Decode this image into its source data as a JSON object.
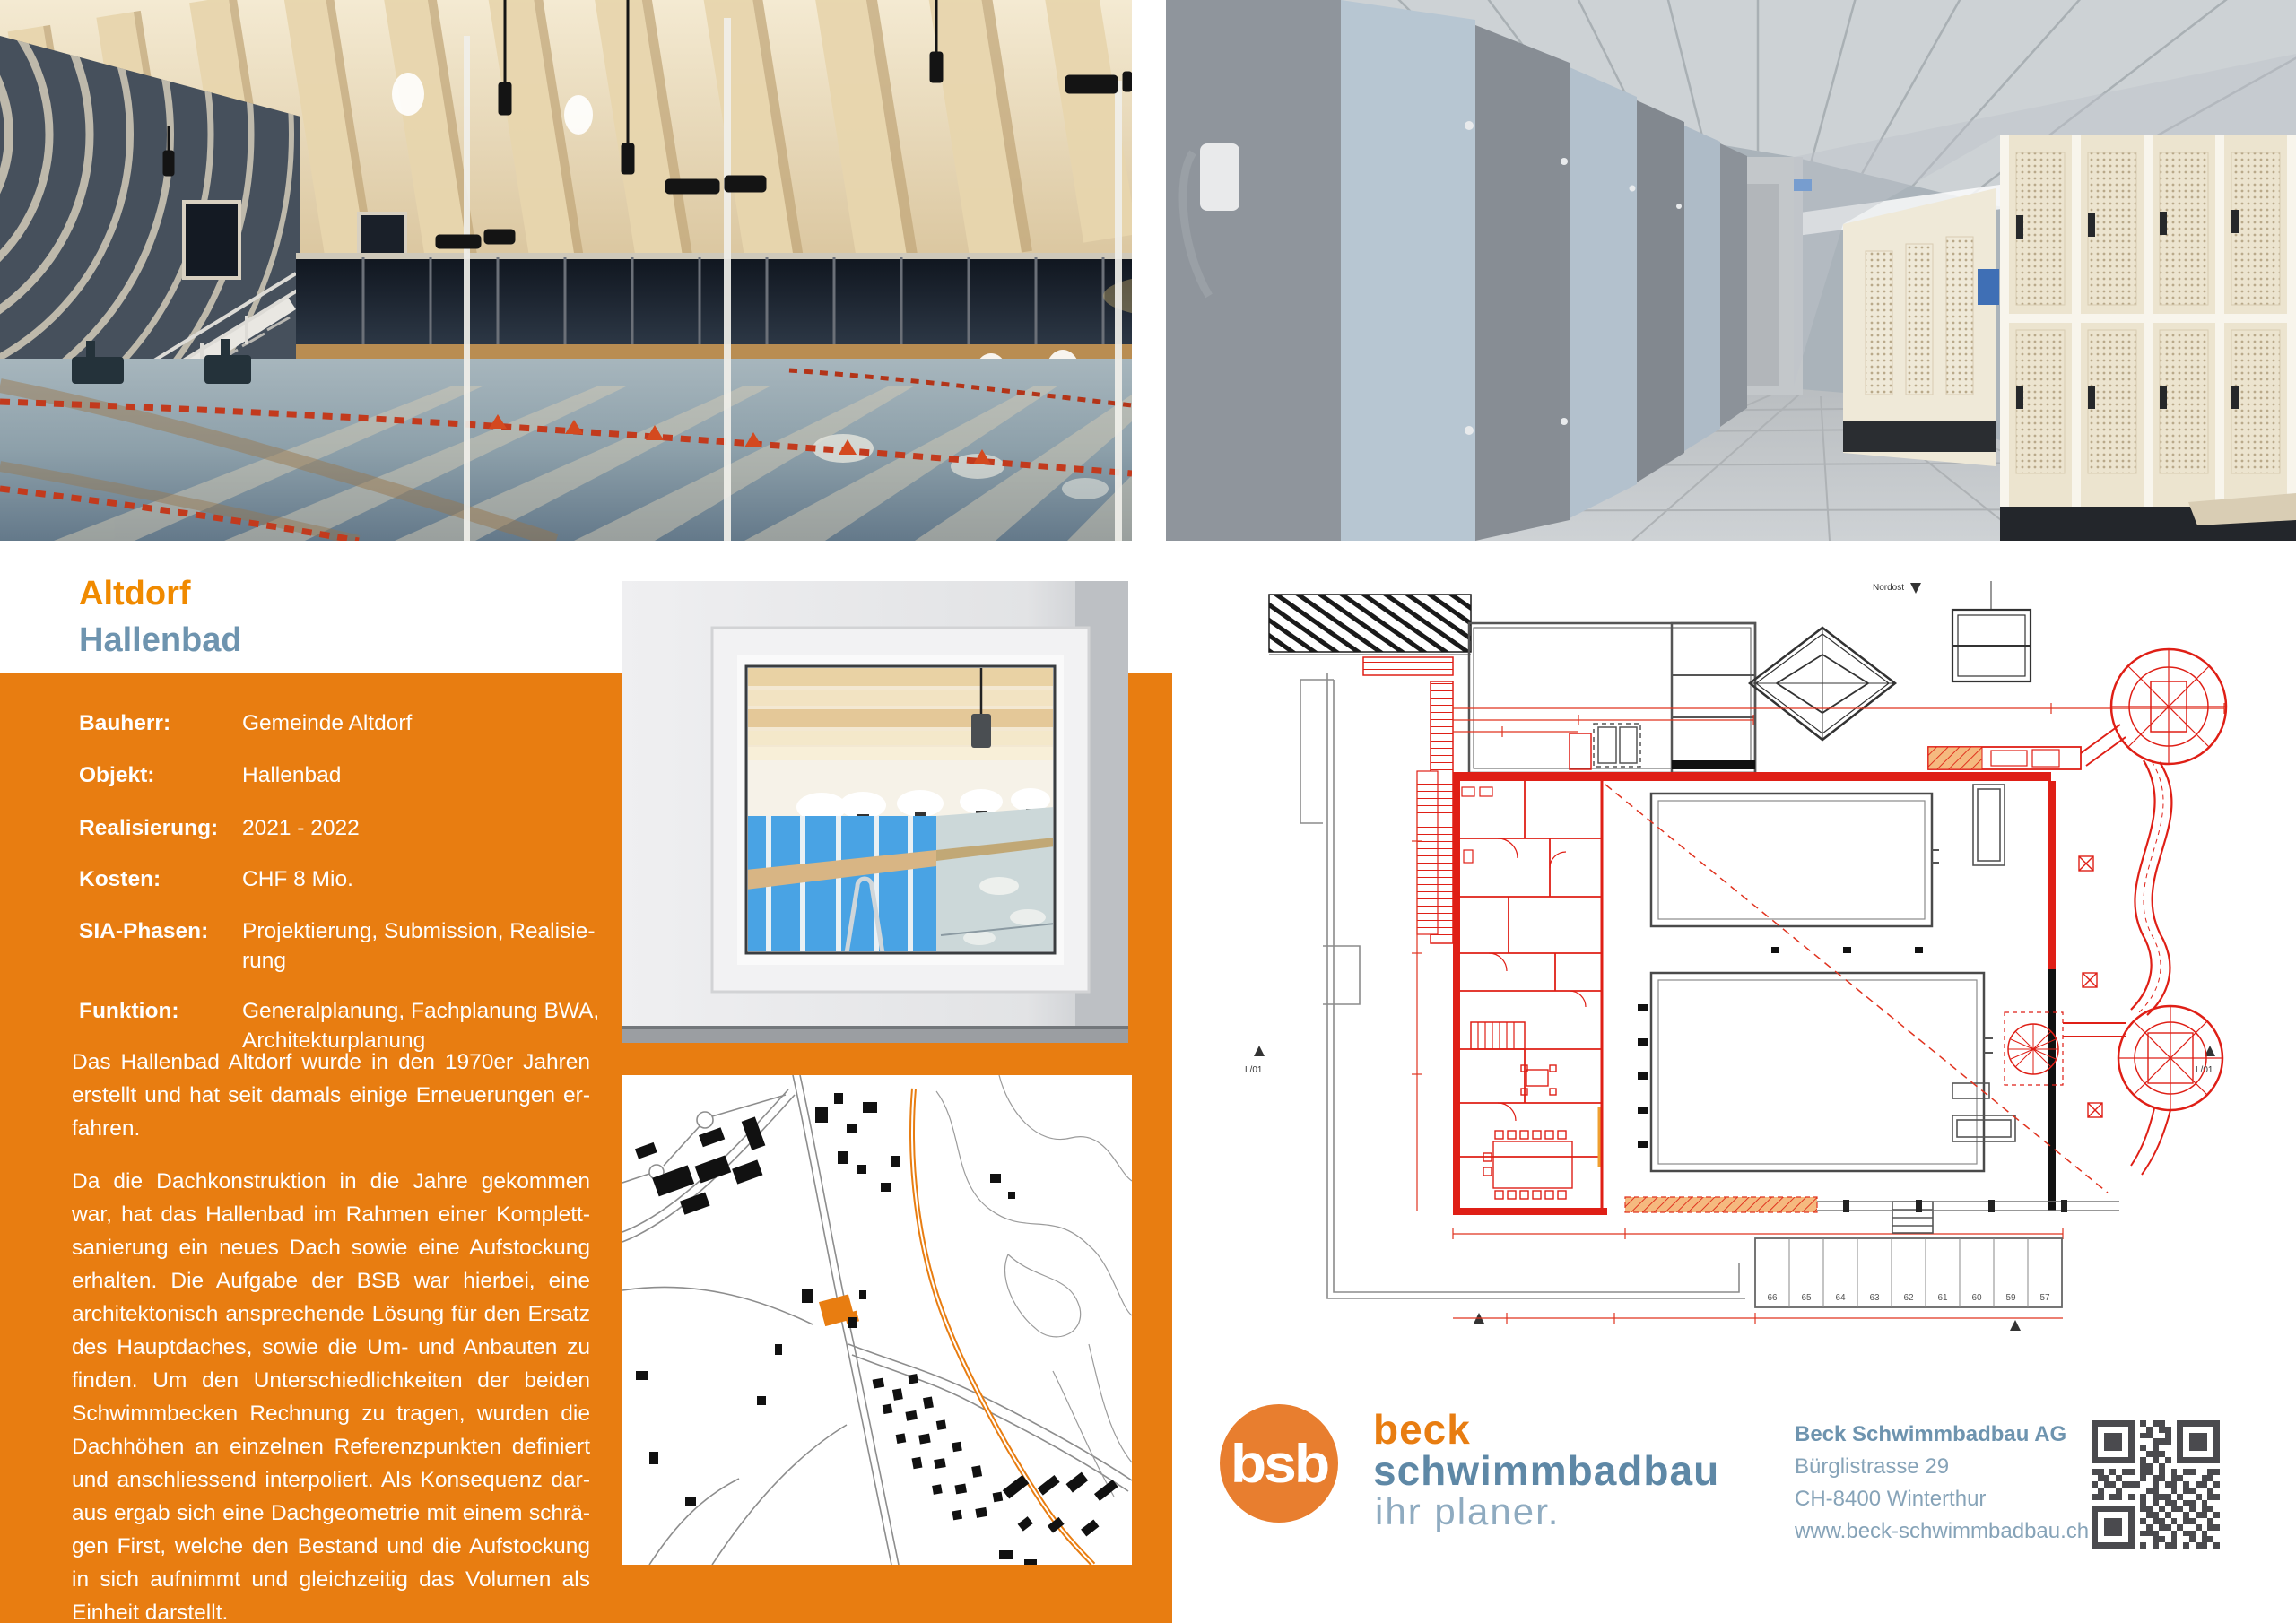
{
  "title": {
    "line1": "Altdorf",
    "line2": "Hallenbad"
  },
  "panel": {
    "fields": [
      {
        "label": "Bauherr:",
        "value_lines": [
          "Gemeinde Altdorf"
        ]
      },
      {
        "label": "Objekt:",
        "value_lines": [
          "Hallenbad"
        ]
      },
      {
        "label": "Realisierung:",
        "value_lines": [
          "2021 - 2022"
        ]
      },
      {
        "label": "Kosten:",
        "value_lines": [
          "CHF 8 Mio."
        ]
      },
      {
        "label": "SIA-Phasen:",
        "value_lines": [
          "Projektierung, Submission, Realisie-",
          "rung"
        ]
      },
      {
        "label": "Funktion:",
        "value_lines": [
          "Generalplanung, Fachplanung BWA,",
          "Architekturplanung"
        ]
      }
    ],
    "paragraph1_lines": [
      "Das Hallenbad Altdorf wurde in den 1970er Jahren",
      "erstellt und hat seit damals einige Erneuerungen er-",
      "fahren."
    ],
    "paragraph2_lines": [
      "Da die Dachkonstruktion in die Jahre gekommen",
      "war, hat das Hallenbad im Rahmen einer Komplett-",
      "sanierung ein neues Dach sowie eine Aufstockung",
      "erhalten. Die Aufgabe der BSB war hierbei, eine",
      "architektonisch ansprechende Lösung für den Ersatz",
      "des Hauptdaches, sowie die Um- und Anbauten zu",
      "finden. Um den Unterschiedlichkeiten der beiden",
      "Schwimmbecken Rechnung zu tragen, wurden die",
      "Dachhöhen an einzelnen Referenzpunkten definiert",
      "und anschliessend interpoliert. Als Konsequenz dar-",
      "aus ergab sich eine Dachgeometrie mit einem schrä-",
      "gen First, welche den Bestand und die Aufstockung",
      "in sich aufnimmt und gleichzeitig das Volumen als",
      "Einheit darstellt."
    ]
  },
  "plan": {
    "north_label": "Nordost",
    "section_marker_left": "L/01",
    "section_marker_right": "L/01",
    "locker_numbers": [
      "66",
      "65",
      "64",
      "63",
      "62",
      "61",
      "60",
      "59",
      "57"
    ]
  },
  "footer": {
    "logo": {
      "monogram": "bsb",
      "line1": "beck",
      "line2": "schwimmbadbau",
      "line3": "ihr planer."
    },
    "address": {
      "company": "Beck Schwimmbadbau AG",
      "street": "Bürglistrasse 29",
      "city": "CH-8400 Winterthur",
      "website": "www.beck-schwimmbadbau.ch"
    },
    "qr_rows": [
      "111111101011001111111",
      "100000100101101000001",
      "101110101100101011101",
      "101110100011101011101",
      "101110101010001011101",
      "100000100111001000001",
      "111111101010101111111",
      "000000001101000000000",
      "110101101101010110011",
      "011010001011011000110",
      "101101110010110101101",
      "010010000110010110010",
      "110110101011101001011",
      "000000001010110110100",
      "111111101101011010110",
      "100000100110100101101",
      "101110101011010110010",
      "101110100101101001011",
      "101110101110010110100",
      "100000100011010010110",
      "111111101010110101101"
    ]
  },
  "colors": {
    "brand_orange": "#E87D11",
    "title_orange": "#F08A00",
    "steel_blue": "#6E94AF",
    "logo_blue": "#5E88A6",
    "address_blue": "#86A3B8",
    "plan_red": "#DF1F16",
    "qr_dark": "#4A4A4E"
  }
}
